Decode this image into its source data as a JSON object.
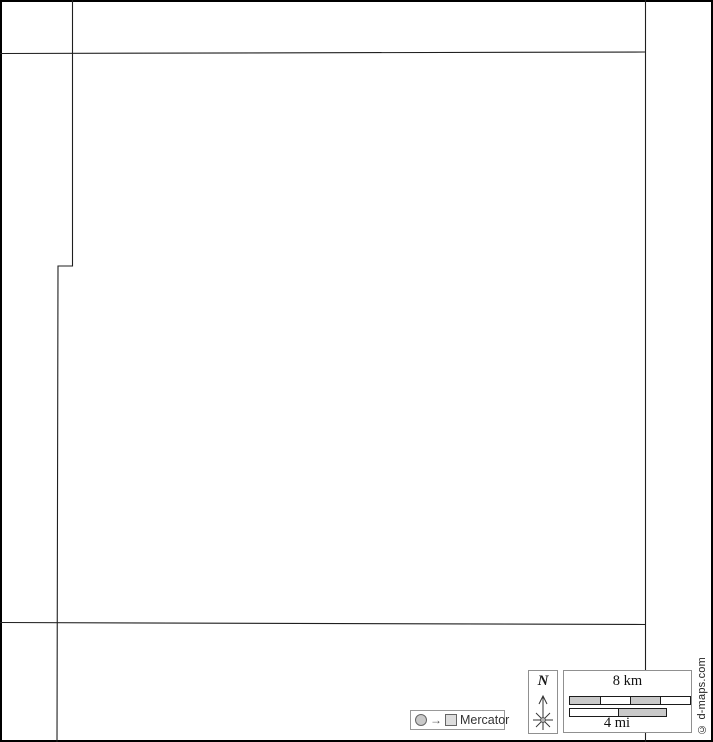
{
  "map": {
    "background": "#ffffff",
    "frame_color": "#000000",
    "stroke_color": "#1f1f1f",
    "lines": [
      {
        "name": "west-county-boundary",
        "points": "72.5,0 72.5,266 58,266 57,742"
      },
      {
        "name": "east-county-boundary",
        "points": "645.5,0 645.5,742"
      },
      {
        "name": "north-county-boundary",
        "points": "0,53.5 645.5,52"
      },
      {
        "name": "south-county-boundary",
        "points": "0,622.5 645.5,624.5"
      }
    ]
  },
  "legend": {
    "north_label": "N",
    "scale": {
      "km_label": "8 km",
      "mi_label": "4 mi",
      "km_bar": {
        "x": 5,
        "y": 25,
        "width": 120,
        "height": 7,
        "fills": [
          "#c9c9c9",
          "#ffffff",
          "#c9c9c9",
          "#ffffff"
        ]
      },
      "mi_bar": {
        "x": 5,
        "y": 37,
        "width": 96,
        "height": 7,
        "fills": [
          "#ffffff",
          "#c9c9c9"
        ]
      }
    },
    "projection_label": "Mercator",
    "copyright": "© d-maps.com"
  },
  "colors": {
    "bar_gray": "#c9c9c9",
    "legend_border": "#909090",
    "compass_stroke": "#333333"
  }
}
